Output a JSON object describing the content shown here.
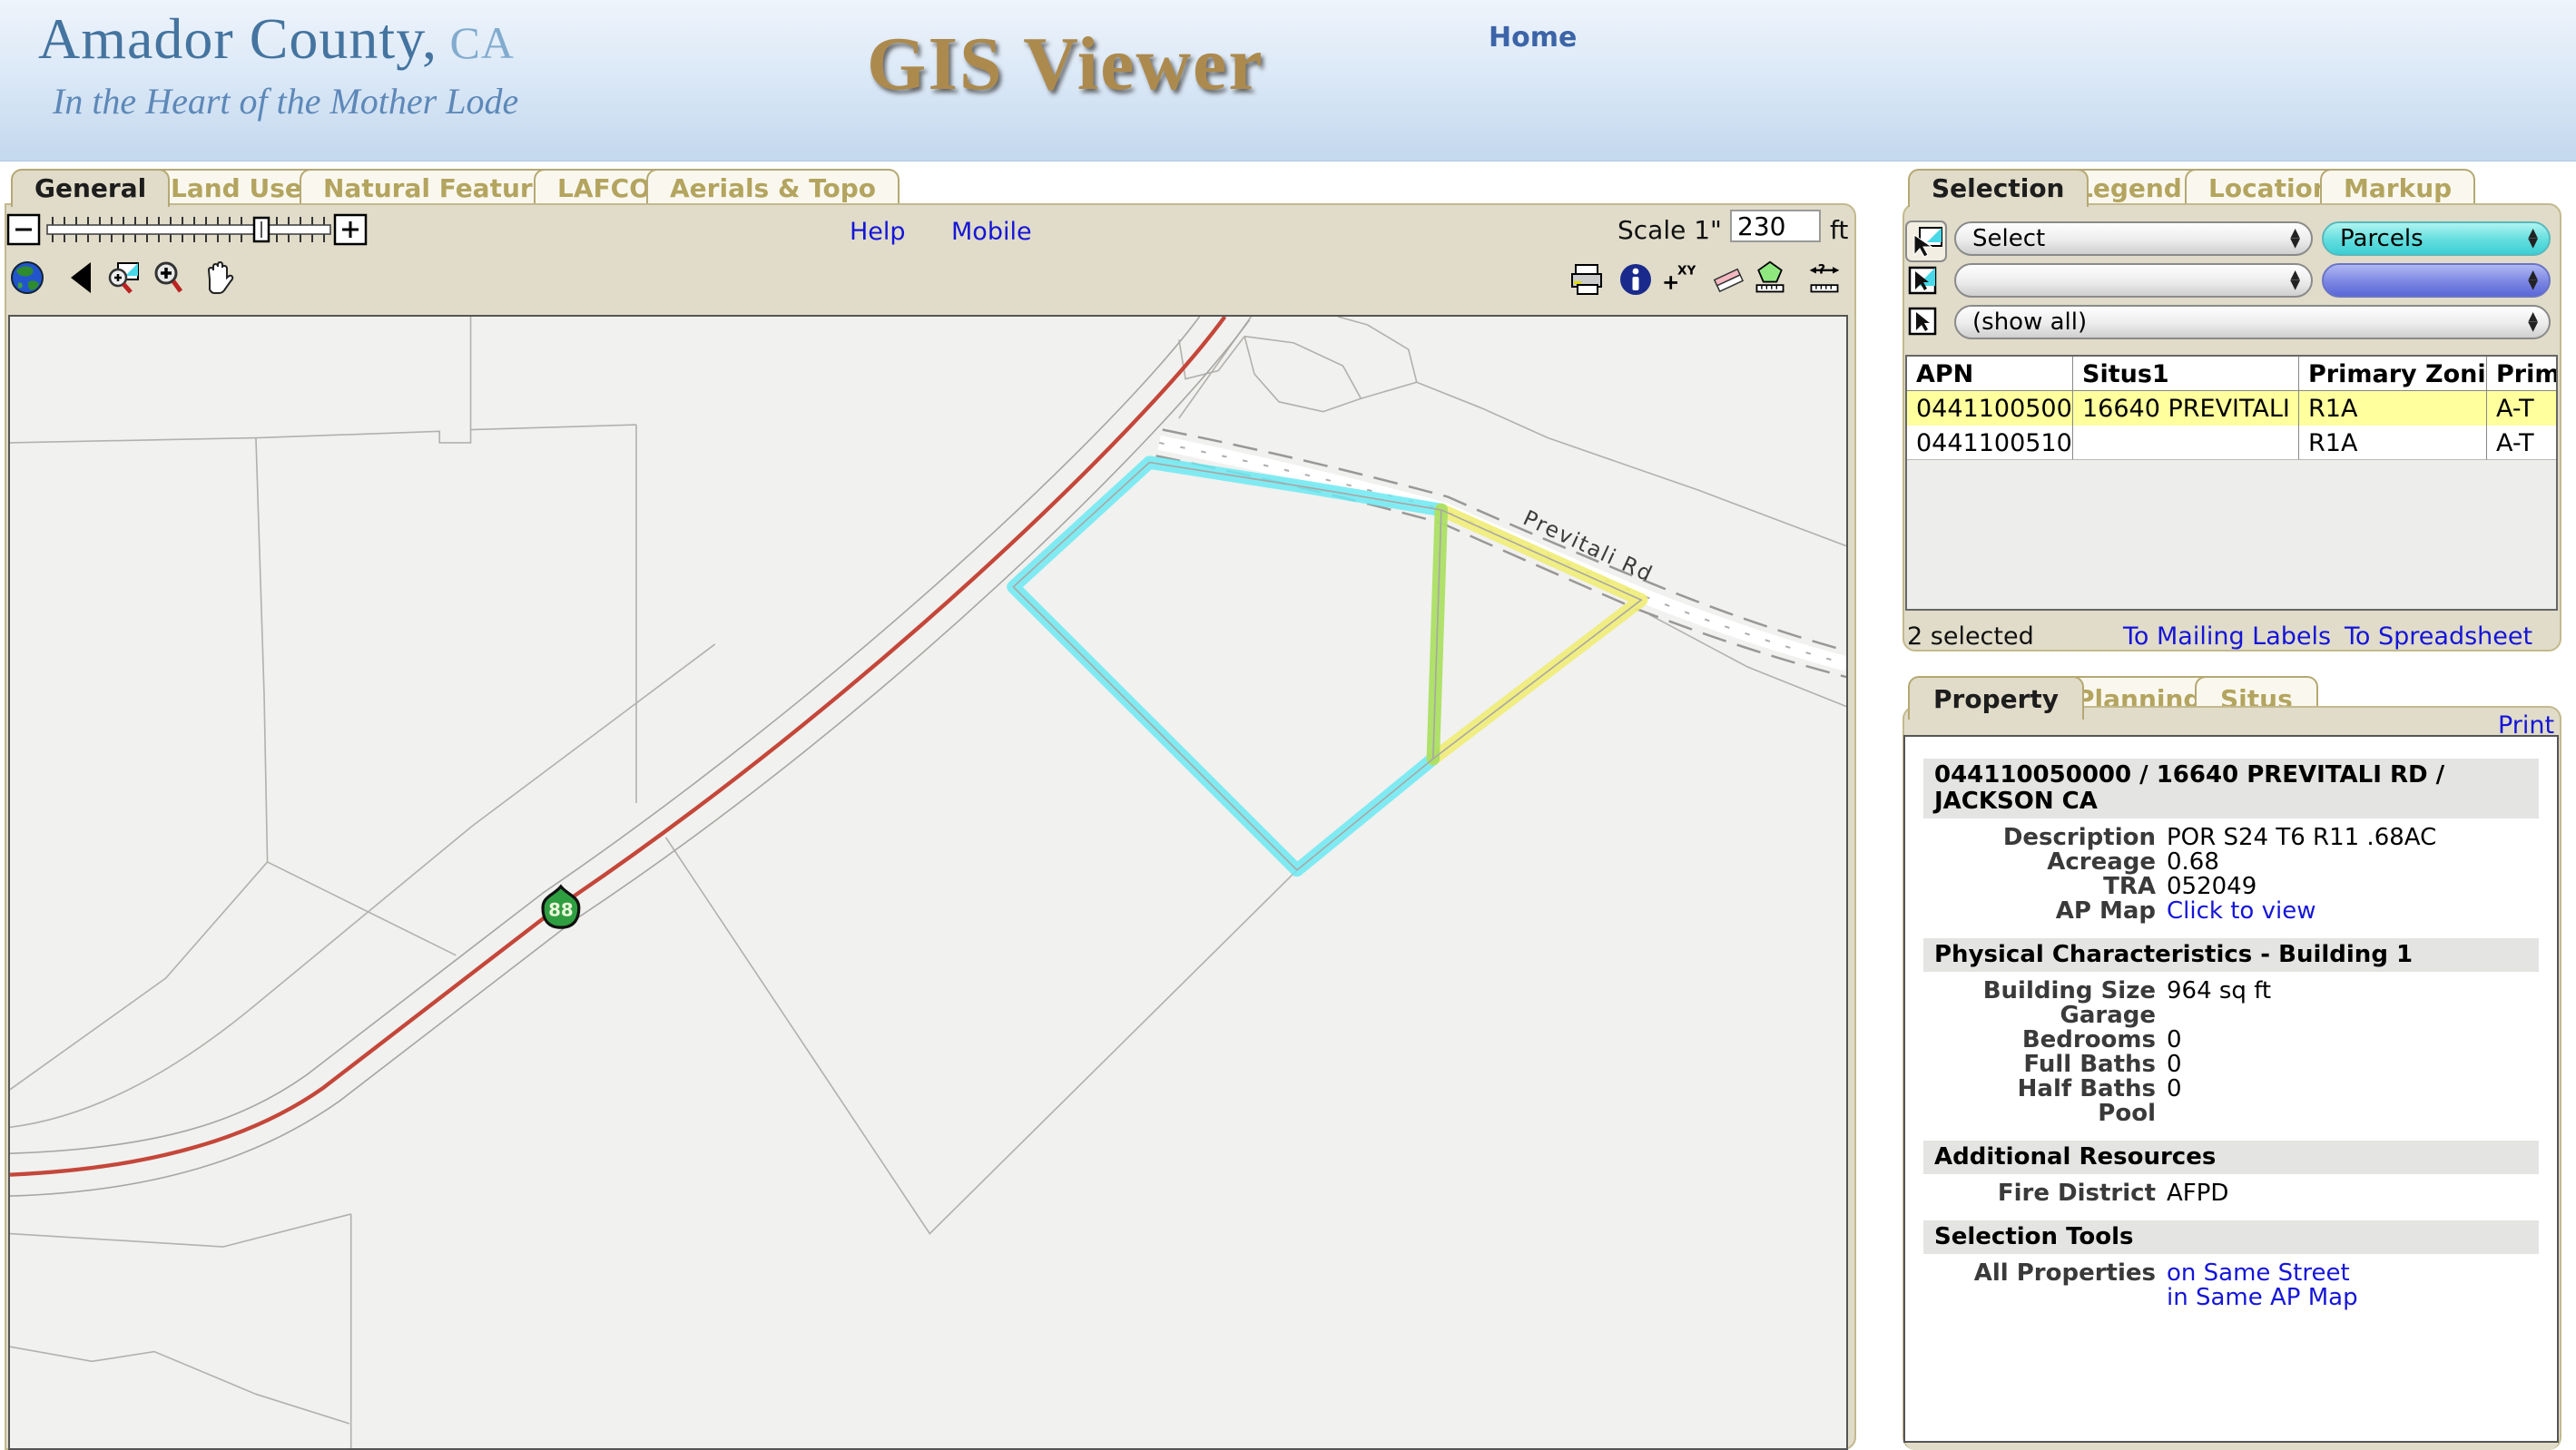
{
  "header": {
    "title_main": "Amador County,",
    "title_suffix": " CA",
    "tagline": "In the Heart of the Mother Lode",
    "app_title": "GIS Viewer",
    "nav_home": "Home"
  },
  "main_tabs": [
    "General",
    "Land Use",
    "Natural Features",
    "LAFCO",
    "Aerials & Topo"
  ],
  "toolbar": {
    "help": "Help",
    "mobile": "Mobile",
    "scale_label": "Scale 1\" =",
    "scale_value": "230",
    "scale_unit": "ft",
    "left_icons": [
      "full-extent-globe",
      "back-arrow",
      "zoom-to-selection",
      "zoom-in",
      "pan-hand"
    ],
    "right_icons": [
      "print",
      "identify-info",
      "add-xy-point",
      "eraser",
      "measure-area",
      "measure-distance"
    ]
  },
  "map": {
    "highway_shield": "88",
    "road_label": "Previtali Rd",
    "colors": {
      "selected_parcel": "#6ce9f2",
      "secondary_parcel": "#efec76",
      "shared_edge": "#abdf63",
      "highway": "#c4473a"
    }
  },
  "right_tabs": [
    "Selection",
    "Legend",
    "Location",
    "Markup"
  ],
  "selection_panel": {
    "dropdown_action": "Select",
    "dropdown_layer": "Parcels",
    "dropdown_value2": "",
    "dropdown_layer2": "",
    "dropdown_filter": "(show all)",
    "table": {
      "columns": [
        "APN",
        "Situs1",
        "Primary Zoning",
        "Primary"
      ],
      "rows": [
        [
          "044110050000",
          "16640 PREVITALI RD",
          "R1A",
          "A-T"
        ],
        [
          "044110051000",
          "",
          "R1A",
          "A-T"
        ]
      ],
      "selected_row_color": "#ffff9e"
    },
    "status": "2 selected",
    "link_mailing": "To Mailing Labels",
    "link_spreadsheet": "To Spreadsheet"
  },
  "detail_tabs": [
    "Property",
    "Planning",
    "Situs"
  ],
  "print_label": "Print",
  "property": {
    "header_line1": "044110050000 / 16640 PREVITALI RD /",
    "header_line2": "JACKSON CA",
    "sections": {
      "physical": "Physical Characteristics - Building 1",
      "additional": "Additional Resources",
      "selection_tools": "Selection Tools"
    },
    "rows": [
      {
        "label": "Description",
        "value": "POR S24 T6 R11 .68AC"
      },
      {
        "label": "Acreage",
        "value": "0.68"
      },
      {
        "label": "TRA",
        "value": "052049"
      },
      {
        "label": "AP Map",
        "value": "Click to view"
      },
      {
        "label": "Building Size",
        "value": "964 sq ft"
      },
      {
        "label": "Garage",
        "value": ""
      },
      {
        "label": "Bedrooms",
        "value": "0"
      },
      {
        "label": "Full Baths",
        "value": "0"
      },
      {
        "label": "Half Baths",
        "value": "0"
      },
      {
        "label": "Pool",
        "value": ""
      },
      {
        "label": "Fire District",
        "value": "AFPD"
      },
      {
        "label": "All Properties",
        "value": "on Same Street"
      }
    ],
    "extra_link": "in Same AP Map"
  }
}
